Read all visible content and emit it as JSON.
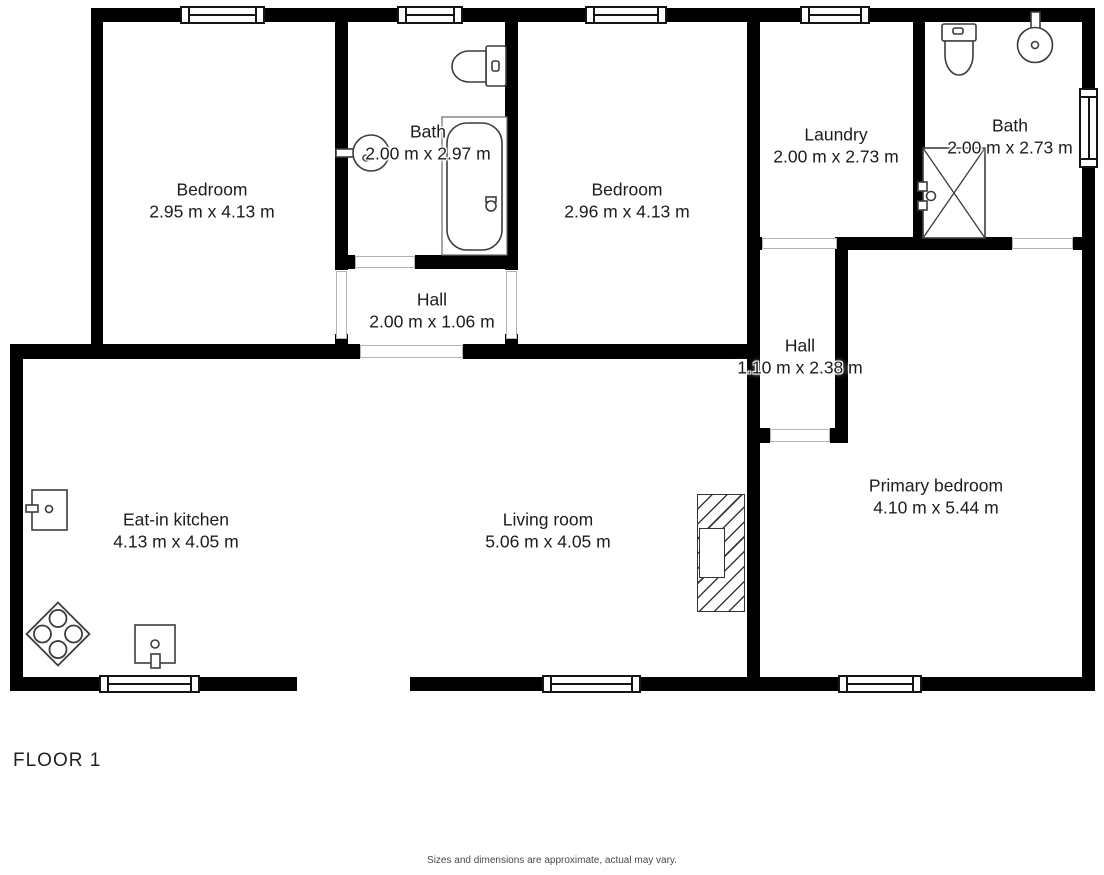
{
  "page": {
    "background": "#ffffff",
    "wall_color": "#000000",
    "label_color": "#1c1c1c",
    "threshold_color": "#b3b3b3",
    "fixture_stroke": "#3c3c3c"
  },
  "plan": {
    "rooms": [
      {
        "id": "bedroom-1",
        "name": "Bedroom",
        "dims": "2.95 m x 4.13 m",
        "cx": 212,
        "cy": 201
      },
      {
        "id": "bath-1",
        "name": "Bath",
        "dims": "2.00 m x 2.97 m",
        "cx": 428,
        "cy": 143
      },
      {
        "id": "bedroom-2",
        "name": "Bedroom",
        "dims": "2.96 m x 4.13 m",
        "cx": 627,
        "cy": 201
      },
      {
        "id": "hall-1",
        "name": "Hall",
        "dims": "2.00 m x 1.06 m",
        "cx": 432,
        "cy": 311
      },
      {
        "id": "laundry",
        "name": "Laundry",
        "dims": "2.00 m x 2.73 m",
        "cx": 836,
        "cy": 146
      },
      {
        "id": "bath-2",
        "name": "Bath",
        "dims": "2.00 m x 2.73 m",
        "cx": 1010,
        "cy": 137
      },
      {
        "id": "hall-2",
        "name": "Hall",
        "dims": "1.10 m x 2.38 m",
        "cx": 800,
        "cy": 357
      },
      {
        "id": "eat-in-kitchen",
        "name": "Eat-in kitchen",
        "dims": "4.13 m x 4.05 m",
        "cx": 176,
        "cy": 531
      },
      {
        "id": "living-room",
        "name": "Living room",
        "dims": "5.06 m x 4.05 m",
        "cx": 548,
        "cy": 531
      },
      {
        "id": "primary-bedroom",
        "name": "Primary bedroom",
        "dims": "4.10 m x 5.44 m",
        "cx": 936,
        "cy": 497
      }
    ],
    "fixtures": [
      "toilet-icon",
      "sink-icon",
      "bathtub-icon",
      "toilet-icon",
      "sink-icon",
      "shower-icon",
      "fridge-icon",
      "stove-icon",
      "dishwasher-icon",
      "fireplace-icon"
    ]
  },
  "footer": {
    "floor_label": "FLOOR 1",
    "disclaimer": "Sizes and dimensions are approximate, actual may vary."
  }
}
